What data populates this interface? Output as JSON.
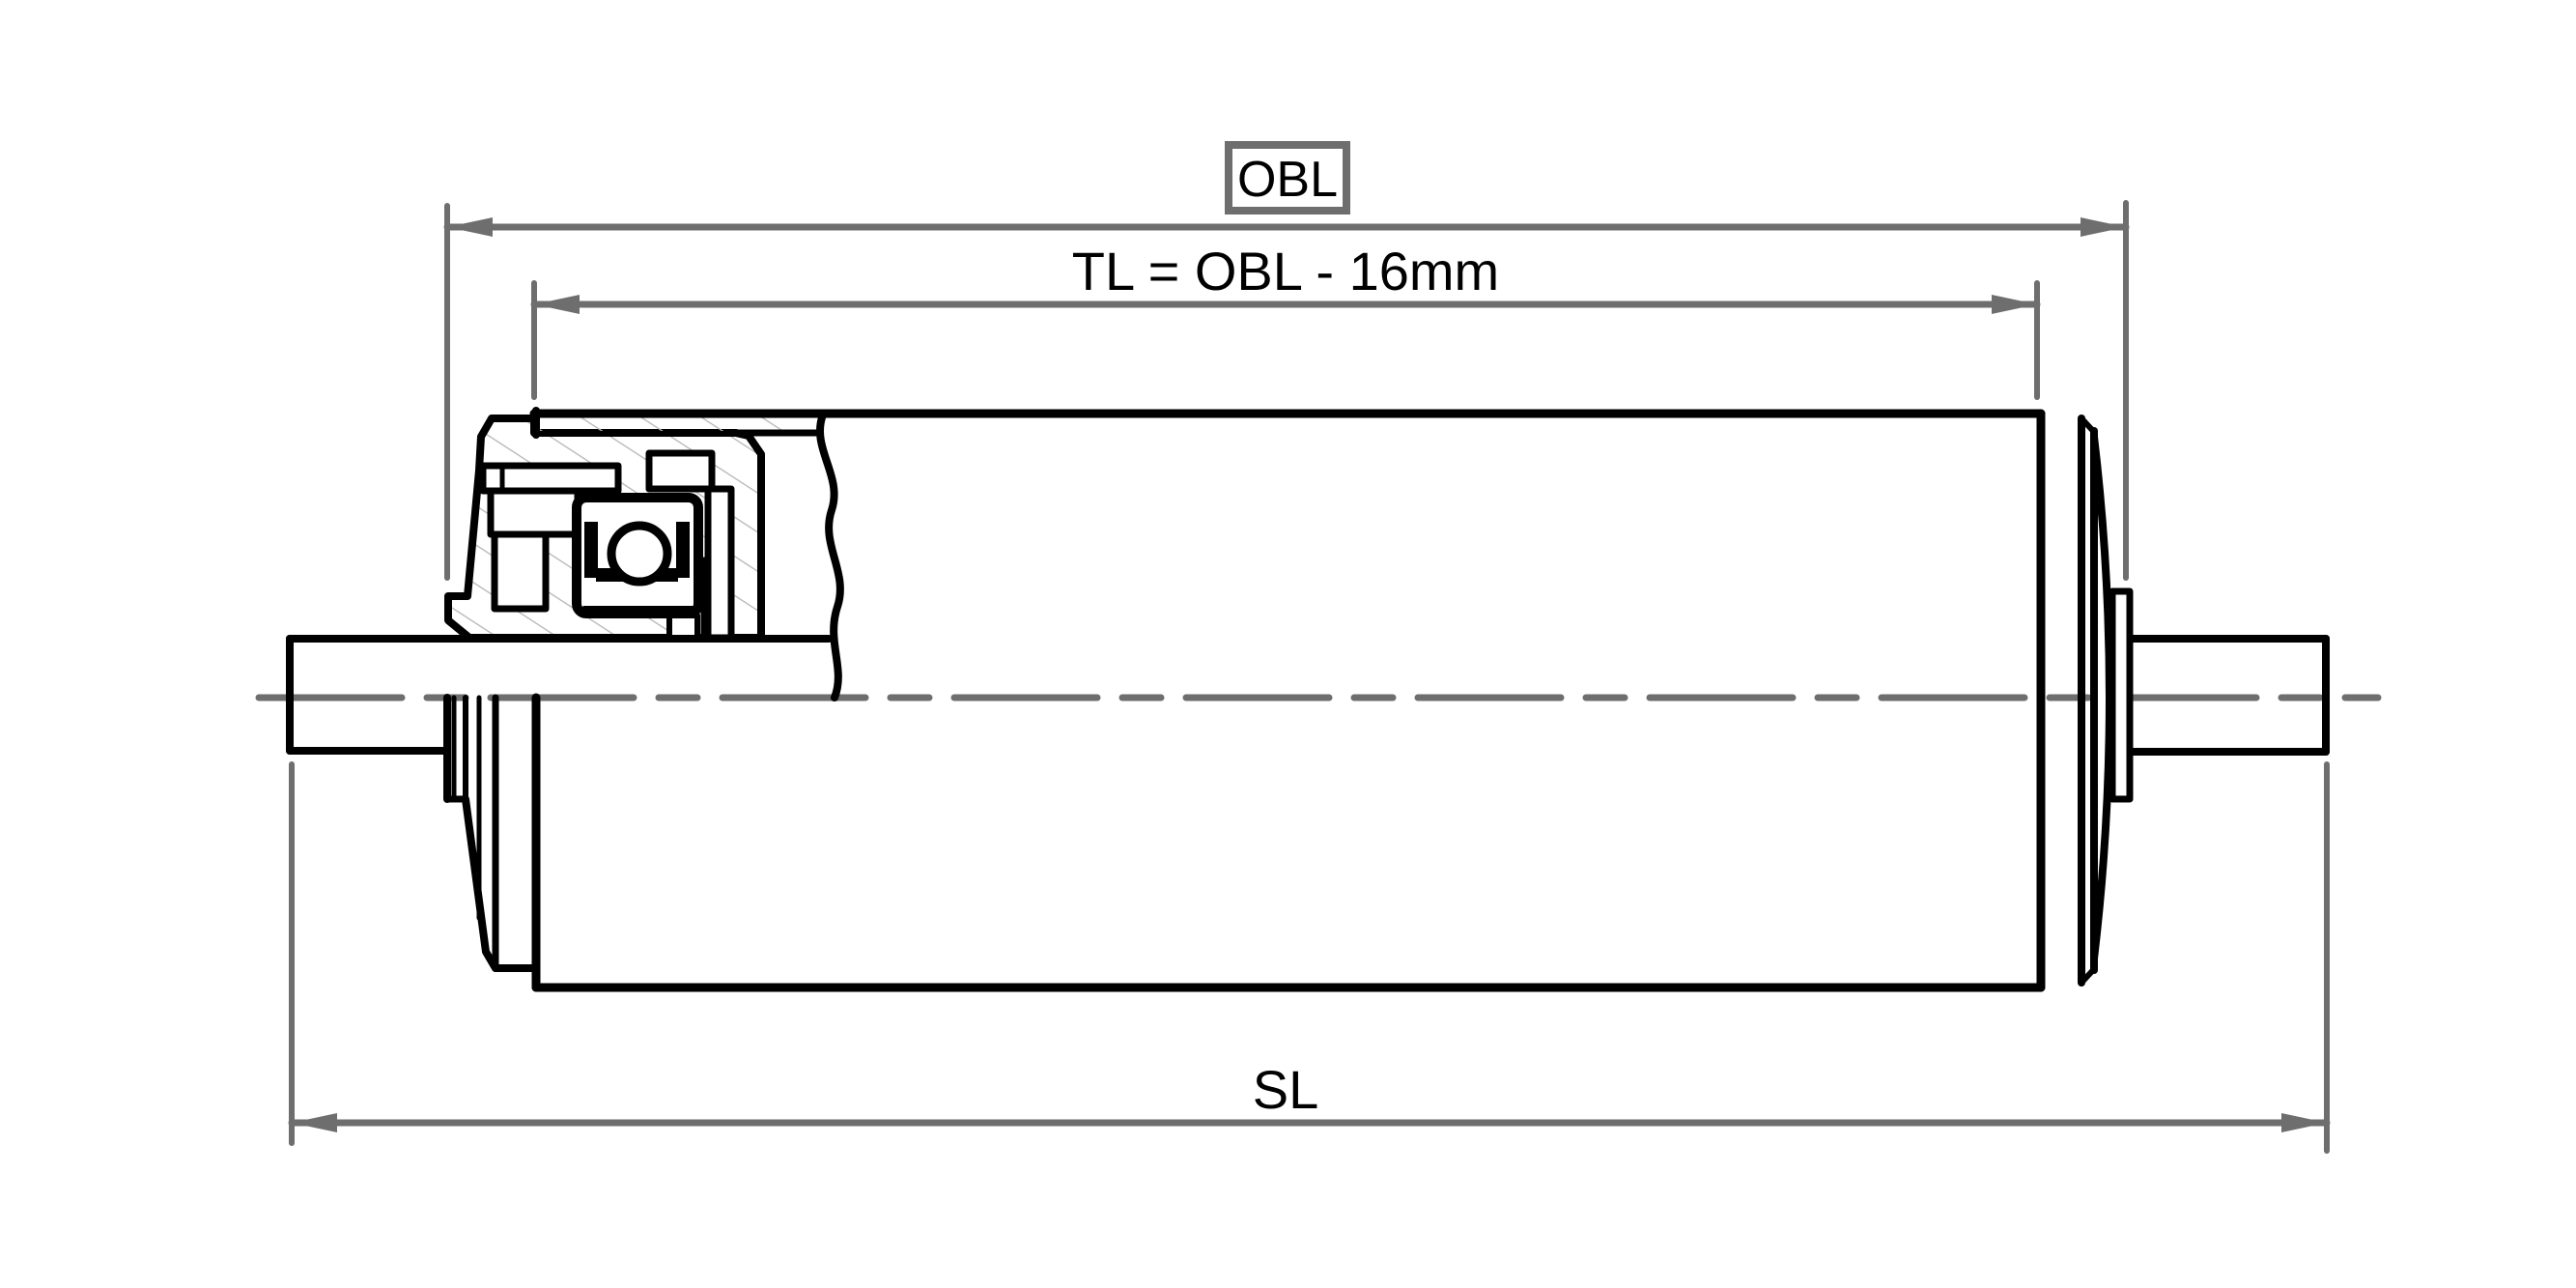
{
  "drawing": {
    "type": "technical-half-section-drawing",
    "subject": "conveyor roller with shaft and bearing housing",
    "dimensions": {
      "obl": {
        "label": "OBL",
        "boxed": true
      },
      "tl": {
        "label": "TL = OBL - 16mm",
        "boxed": false
      },
      "sl": {
        "label": "SL",
        "boxed": false
      }
    },
    "colors": {
      "outline": "#000000",
      "dimension": "#6e6e6e",
      "hatch": "#b5b5b5",
      "background": "#ffffff"
    }
  }
}
